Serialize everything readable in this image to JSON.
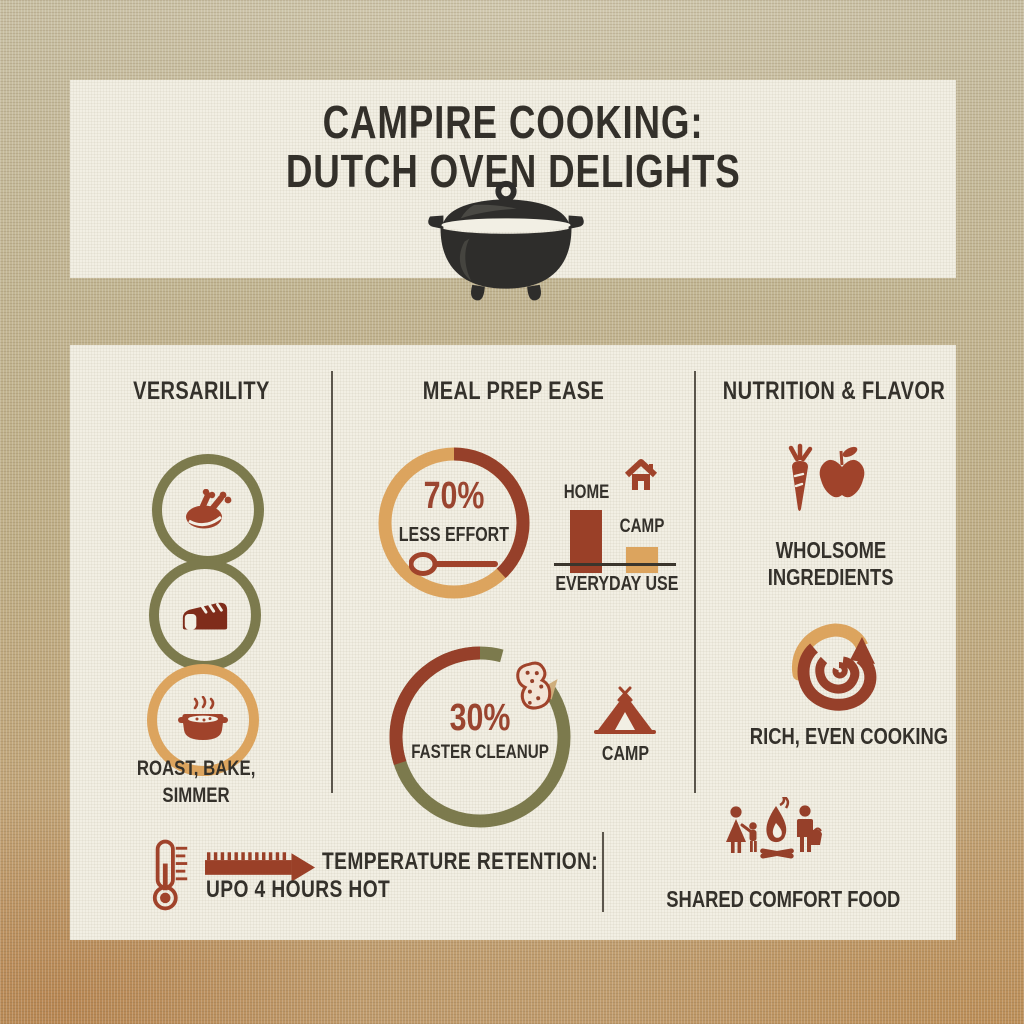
{
  "title": {
    "line1": "CAMPIRE COOKING:",
    "line2": "DUTCH OVEN DELIGHTS"
  },
  "columns": {
    "versatility": {
      "header": "VERSARILITY",
      "icons": [
        "roast-turkey-icon",
        "bread-loaf-icon",
        "simmer-pot-icon"
      ],
      "caption": {
        "line1": "ROAST, BAKE,",
        "line2": "SIMMER"
      }
    },
    "meal_prep": {
      "header": "MEAL PREP EASE",
      "effort": {
        "value": "70%",
        "label": "LESS EFFORT"
      },
      "usage_chart": {
        "home_label": "HOME",
        "camp_label": "CAMP",
        "caption": "EVERYDAY USE"
      },
      "cleanup": {
        "value": "30%",
        "label": "FASTER CLEANUP"
      },
      "camp_caption": "CAMP"
    },
    "nutrition": {
      "header": "NUTRITION & FLAVOR",
      "caption1": {
        "line1": "WHOLSOME",
        "line2": "INGREDIENTS"
      },
      "caption2": "RICH, EVEN COOKING"
    }
  },
  "footer": {
    "temperature": {
      "line1": "TEMPERATURE RETENTION:",
      "line2": "UPO 4 HOURS HOT"
    },
    "shared_caption": "SHARED COMFORT FOOD"
  },
  "colors": {
    "cream": "#f2efe4",
    "ink": "#34312b",
    "rust": "#a0432b",
    "rust_dark": "#96402a",
    "maroon": "#7f2c1a",
    "olive": "#7c7a4d",
    "tan": "#dca45e",
    "burlap": "#c2b28c"
  },
  "chart_data": [
    {
      "type": "donut",
      "title": "LESS EFFORT donut",
      "value": 70,
      "label": "70% LESS EFFORT",
      "arc_fraction_shown": 0.38,
      "ring_color": "#dca45e",
      "arc_color": "#96402a"
    },
    {
      "type": "bar",
      "title": "EVERYDAY USE",
      "categories": [
        "HOME",
        "CAMP"
      ],
      "values": [
        100,
        41
      ],
      "bar_colors": [
        "#9a4028",
        "#dca45e"
      ],
      "note": "bars unlabeled; relative heights estimated from pixels"
    },
    {
      "type": "donut",
      "title": "FASTER CLEANUP donut",
      "value": 30,
      "label": "30% FASTER CLEANUP",
      "arc_fraction_shown": 0.3,
      "ring_color": "#7c7a4d",
      "arc_color": "#96402a"
    }
  ]
}
